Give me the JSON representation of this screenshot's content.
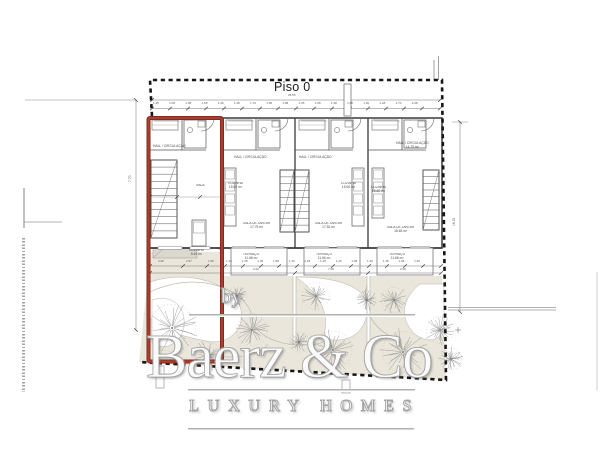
{
  "plan": {
    "title": "Piso 0",
    "rooms": {
      "hall": {
        "label": "HALL / CIRCULAÇÃO"
      },
      "hall_main": {
        "label": "HALL / CIRCULAÇÃO",
        "area": "14.70 m²"
      },
      "sala": {
        "label": "SALA"
      },
      "cozinha_a": {
        "label": "COZINHA",
        "area": "8.40 m²"
      },
      "cozinha_b": {
        "label": "COZINHA",
        "area": "18.60 m²"
      },
      "cozinha_c": {
        "label": "COZINHA",
        "area": "15.60 m²"
      },
      "sala_jantar_a": {
        "label": "SALA DE JANTAR",
        "area": "17.75 m²"
      },
      "sala_jantar_b": {
        "label": "SALA DE JANTAR",
        "area": "17.52 m²"
      },
      "sala_jantar_c": {
        "label": "SALA DE JANTAR",
        "area": "18.63 m²"
      },
      "terraco": {
        "label": "TERRAÇO",
        "area": "11.66 m²"
      }
    },
    "dims": {
      "overall_width": "25.55",
      "left_height": "7.70",
      "right_height": "16.15",
      "top_segments": "1.35 1.08 1.38 1.58 1.36 1.48 1.70 1.38 1.98 1.35 1.08 1.38 1.58 1.36 1.48 1.70 2.08",
      "terrace_segments": "1.18 1.48 1.30 1.98 1.40 1.18 1.48 1.30 1.98 1.40 1.18 1.48 1.30",
      "lower_spans": [
        "2.62",
        "7.08",
        "3.08"
      ],
      "garden_left": [
        "2.98",
        "2.97",
        "1.59"
      ]
    }
  },
  "watermark": {
    "by": "by",
    "brand": "Baerz & Co",
    "tagline": "LUXURY HOMES"
  },
  "colors": {
    "accent_red": "#9e3a2b",
    "boundary_black": "#161616",
    "garden_beige": "#eae6db"
  }
}
